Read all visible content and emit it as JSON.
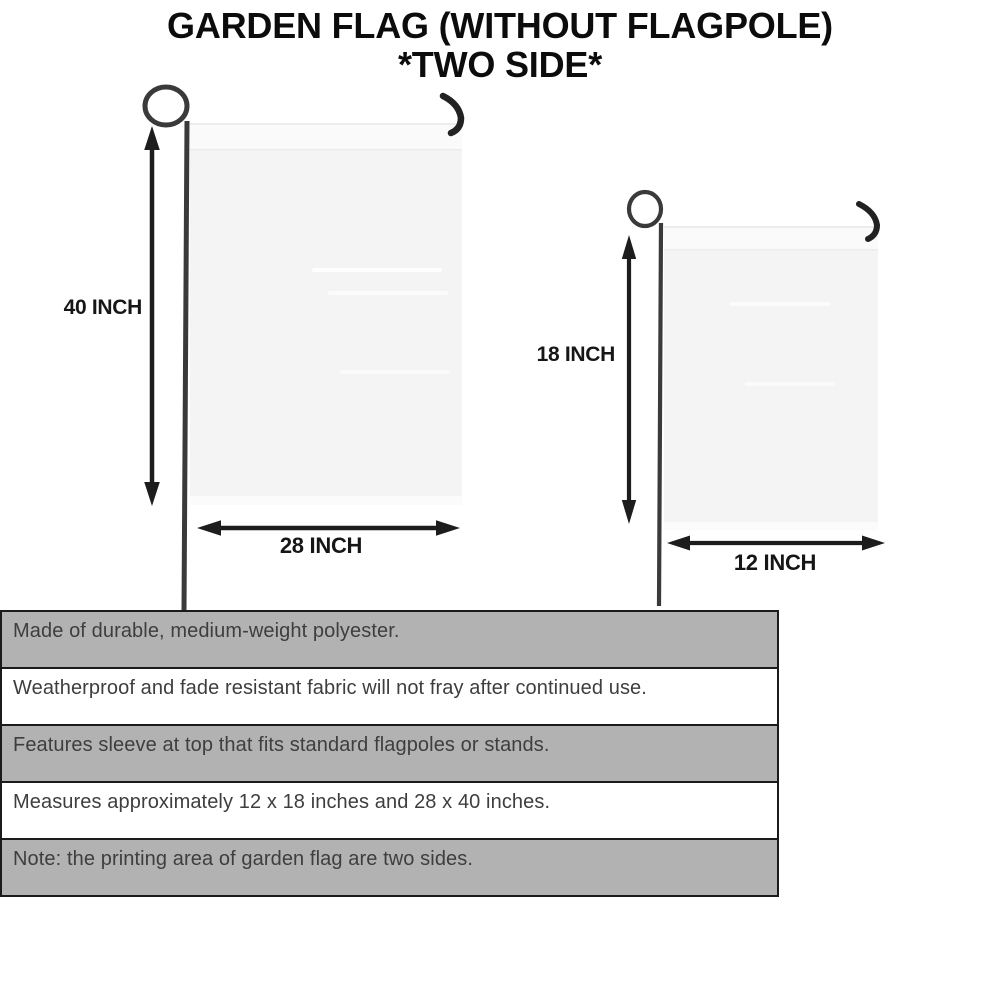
{
  "title": {
    "line1": "GARDEN FLAG (WITHOUT FLAGPOLE)",
    "line2": "*TWO SIDE*"
  },
  "diagrams": {
    "large": {
      "height_label": "40 INCH",
      "width_label": "28 INCH"
    },
    "small": {
      "height_label": "18 INCH",
      "width_label": "12 INCH"
    }
  },
  "features": {
    "rows": [
      "Made of durable, medium-weight polyester.",
      "Weatherproof and fade resistant fabric will not fray after continued use.",
      "Features sleeve at top that fits standard flagpoles or stands.",
      "Measures approximately 12 x 18 inches and 28 x 40 inches.",
      "Note: the printing area of garden flag are two sides."
    ]
  },
  "colors": {
    "row_shade": "#b2b2b2",
    "table_border": "#1b1b1b",
    "flag_fill": "#f4f4f4",
    "line_color": "#1d1d1d",
    "pole_color": "#3a3a3a",
    "text_color": "#3e3e3e",
    "title_color": "#0c0c0c"
  }
}
